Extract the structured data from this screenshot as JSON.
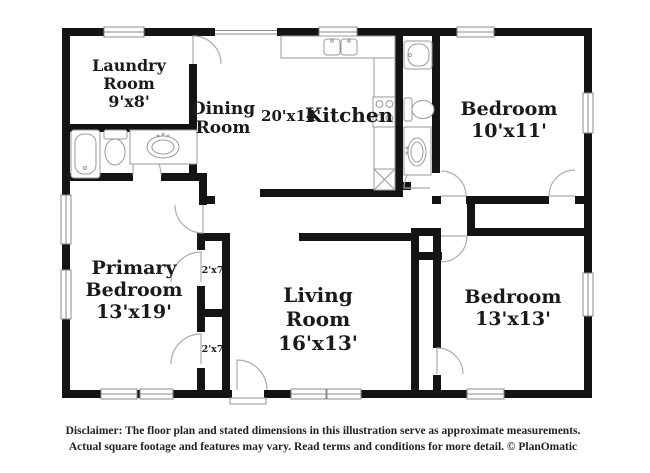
{
  "title": "Residential floor plan",
  "rooms": {
    "laundry": {
      "name_line1": "Laundry",
      "name_line2": "Room",
      "dims": "9'x8'"
    },
    "dining": {
      "name_line1": "Dining",
      "name_line2": "Room"
    },
    "kitchen": {
      "dims": "20'x14'",
      "name": "Kitchen"
    },
    "bedroom_top_right": {
      "name": "Bedroom",
      "dims": "10'x11'"
    },
    "primary_bedroom": {
      "name_line1": "Primary",
      "name_line2": "Bedroom",
      "dims": "13'x19'"
    },
    "living_room": {
      "name_line1": "Living",
      "name_line2": "Room",
      "dims": "16'x13'"
    },
    "bedroom_bottom_right": {
      "name": "Bedroom",
      "dims": "13'x13'"
    },
    "closet_top": {
      "dims": "2'x7'"
    },
    "closet_bottom": {
      "dims": "2'x7'"
    }
  },
  "footer": {
    "disclaimer_line1": "Disclaimer: The floor plan and stated dimensions in this illustration serve as approximate measurements.",
    "disclaimer_line2": "Actual square footage and features may vary. Read terms and conditions for more detail. © PlanOmatic"
  },
  "colors": {
    "walls": "#141414",
    "fixture_outline": "#9a9a9a",
    "window_frame": "#8b8b8b",
    "label_text": "#1a1a1a",
    "background": "#ffffff"
  }
}
